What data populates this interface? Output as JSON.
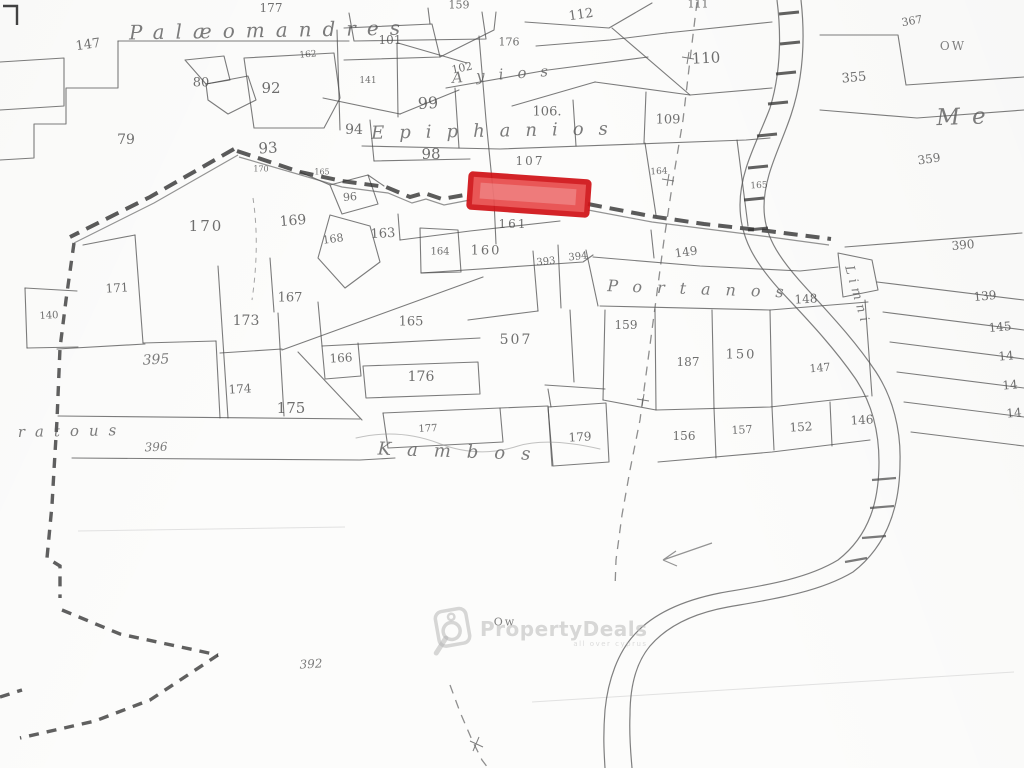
{
  "watermark": {
    "brand": "PropertyDeals",
    "tagline": "all over cyprus",
    "color": "#bdbdbd"
  },
  "map": {
    "highlight": {
      "stroke": "#d01318",
      "fill": "#e84b4b"
    },
    "labels": [
      {
        "text": "147",
        "x": 88,
        "y": 45,
        "s": 13,
        "rot": -8
      },
      {
        "text": "177",
        "x": 271,
        "y": 8,
        "s": 12
      },
      {
        "text": "159",
        "x": 459,
        "y": 5,
        "s": 11
      },
      {
        "text": "112",
        "x": 581,
        "y": 15,
        "s": 13,
        "rot": -8
      },
      {
        "text": "111",
        "x": 698,
        "y": 4,
        "s": 11
      },
      {
        "text": "367",
        "x": 912,
        "y": 21,
        "s": 11,
        "rot": -10
      },
      {
        "text": "OW",
        "x": 953,
        "y": 46,
        "s": 12,
        "cls": "mark",
        "name": "well-mark-ow"
      },
      {
        "text": "101",
        "x": 390,
        "y": 40,
        "s": 12
      },
      {
        "text": "162",
        "x": 308,
        "y": 55,
        "s": 9,
        "rot": -5
      },
      {
        "text": "102",
        "x": 462,
        "y": 68,
        "s": 11,
        "rot": -12
      },
      {
        "text": "176",
        "x": 509,
        "y": 42,
        "s": 11
      },
      {
        "text": "110",
        "x": 706,
        "y": 58,
        "s": 15,
        "rot": -3
      },
      {
        "text": "355",
        "x": 854,
        "y": 78,
        "s": 13,
        "rot": -5
      },
      {
        "text": "80",
        "x": 201,
        "y": 83,
        "s": 13
      },
      {
        "text": "92",
        "x": 271,
        "y": 88,
        "s": 15
      },
      {
        "text": "141",
        "x": 368,
        "y": 81,
        "s": 9
      },
      {
        "text": "99",
        "x": 428,
        "y": 103,
        "s": 16,
        "rot": -3
      },
      {
        "text": "106.",
        "x": 547,
        "y": 112,
        "s": 13
      },
      {
        "text": "109",
        "x": 668,
        "y": 120,
        "s": 13
      },
      {
        "text": "79",
        "x": 126,
        "y": 140,
        "s": 14
      },
      {
        "text": "93",
        "x": 268,
        "y": 148,
        "s": 15,
        "rot": -3
      },
      {
        "text": "94",
        "x": 354,
        "y": 130,
        "s": 14
      },
      {
        "text": "98",
        "x": 431,
        "y": 154,
        "s": 15
      },
      {
        "text": "107",
        "x": 530,
        "y": 161,
        "s": 12,
        "ls": 2
      },
      {
        "text": "359",
        "x": 929,
        "y": 159,
        "s": 12,
        "rot": -8
      },
      {
        "text": "164",
        "x": 659,
        "y": 172,
        "s": 9,
        "rot": -3
      },
      {
        "text": "165",
        "x": 759,
        "y": 186,
        "s": 9,
        "rot": -3
      },
      {
        "text": "170",
        "x": 261,
        "y": 169,
        "s": 8
      },
      {
        "text": "165",
        "x": 322,
        "y": 172,
        "s": 8
      },
      {
        "text": "96",
        "x": 350,
        "y": 197,
        "s": 11,
        "rot": -5
      },
      {
        "text": "170",
        "x": 206,
        "y": 226,
        "s": 15,
        "ls": 2
      },
      {
        "text": "169",
        "x": 293,
        "y": 221,
        "s": 14,
        "rot": -5
      },
      {
        "text": "168",
        "x": 333,
        "y": 239,
        "s": 11,
        "rot": -8
      },
      {
        "text": "163",
        "x": 383,
        "y": 234,
        "s": 13,
        "rot": -3
      },
      {
        "text": "161",
        "x": 513,
        "y": 224,
        "s": 12,
        "ls": 2
      },
      {
        "text": "164",
        "x": 440,
        "y": 252,
        "s": 10
      },
      {
        "text": "160",
        "x": 486,
        "y": 251,
        "s": 13,
        "ls": 2
      },
      {
        "text": "393",
        "x": 546,
        "y": 262,
        "s": 10,
        "rot": -6
      },
      {
        "text": "394",
        "x": 578,
        "y": 257,
        "s": 10,
        "rot": -6
      },
      {
        "text": "149",
        "x": 686,
        "y": 252,
        "s": 12,
        "rot": -8
      },
      {
        "text": "390",
        "x": 963,
        "y": 245,
        "s": 12,
        "rot": -5
      },
      {
        "text": "148",
        "x": 806,
        "y": 299,
        "s": 12,
        "rot": -3
      },
      {
        "text": "139",
        "x": 985,
        "y": 296,
        "s": 12,
        "rot": -5
      },
      {
        "text": "145",
        "x": 1000,
        "y": 327,
        "s": 12,
        "rot": -5
      },
      {
        "text": "14",
        "x": 1006,
        "y": 356,
        "s": 12,
        "rot": -5
      },
      {
        "text": "14",
        "x": 1010,
        "y": 385,
        "s": 12,
        "rot": -5
      },
      {
        "text": "14",
        "x": 1014,
        "y": 413,
        "s": 12,
        "rot": -5
      },
      {
        "text": "171",
        "x": 117,
        "y": 288,
        "s": 12,
        "rot": -3
      },
      {
        "text": "140",
        "x": 49,
        "y": 316,
        "s": 10,
        "rot": -3
      },
      {
        "text": "167",
        "x": 290,
        "y": 298,
        "s": 13
      },
      {
        "text": "173",
        "x": 246,
        "y": 321,
        "s": 14
      },
      {
        "text": "165",
        "x": 411,
        "y": 322,
        "s": 13
      },
      {
        "text": "159",
        "x": 626,
        "y": 325,
        "s": 12
      },
      {
        "text": "395",
        "x": 156,
        "y": 360,
        "s": 14,
        "cls": "script",
        "rot": -3
      },
      {
        "text": "507",
        "x": 516,
        "y": 340,
        "s": 14,
        "ls": 2
      },
      {
        "text": "187",
        "x": 688,
        "y": 362,
        "s": 12
      },
      {
        "text": "150",
        "x": 741,
        "y": 355,
        "s": 13,
        "ls": 2
      },
      {
        "text": "147",
        "x": 820,
        "y": 368,
        "s": 11,
        "rot": -5
      },
      {
        "text": "166",
        "x": 341,
        "y": 358,
        "s": 12,
        "rot": -3
      },
      {
        "text": "176",
        "x": 421,
        "y": 377,
        "s": 14
      },
      {
        "text": "174",
        "x": 240,
        "y": 389,
        "s": 12,
        "rot": -3
      },
      {
        "text": "175",
        "x": 291,
        "y": 408,
        "s": 15
      },
      {
        "text": "177",
        "x": 428,
        "y": 429,
        "s": 10,
        "rot": -3
      },
      {
        "text": "179",
        "x": 580,
        "y": 437,
        "s": 12,
        "rot": -3
      },
      {
        "text": "156",
        "x": 684,
        "y": 436,
        "s": 12
      },
      {
        "text": "157",
        "x": 742,
        "y": 430,
        "s": 11,
        "rot": -3
      },
      {
        "text": "152",
        "x": 801,
        "y": 427,
        "s": 12,
        "rot": -3
      },
      {
        "text": "146",
        "x": 862,
        "y": 420,
        "s": 12,
        "rot": -3
      },
      {
        "text": "396",
        "x": 156,
        "y": 447,
        "s": 12,
        "cls": "script",
        "rot": -2
      },
      {
        "text": "392",
        "x": 311,
        "y": 664,
        "s": 12,
        "cls": "script",
        "rot": -3
      },
      {
        "text": "Ow",
        "x": 505,
        "y": 622,
        "s": 11,
        "cls": "mark",
        "name": "well-mark-ow-2"
      },
      {
        "text": "Palæomandres",
        "x": 270,
        "y": 30,
        "s": 20,
        "ls": 11,
        "rot": -1,
        "cls": "script",
        "name": "place-name-palaeomandres"
      },
      {
        "text": "Ayios",
        "x": 507,
        "y": 74,
        "s": 15,
        "ls": 14,
        "rot": -4,
        "cls": "script",
        "name": "place-name-ayios"
      },
      {
        "text": "Epiphanios",
        "x": 497,
        "y": 131,
        "s": 18,
        "ls": 15,
        "rot": -1,
        "cls": "script",
        "name": "place-name-epiphanios"
      },
      {
        "text": "Me",
        "x": 967,
        "y": 117,
        "s": 23,
        "ls": 12,
        "rot": -2,
        "cls": "script",
        "name": "place-name-me"
      },
      {
        "text": "Portanos",
        "x": 703,
        "y": 289,
        "s": 16,
        "ls": 15,
        "rot": 2,
        "cls": "script",
        "name": "place-name-portanos"
      },
      {
        "text": "Kambos",
        "x": 462,
        "y": 452,
        "s": 18,
        "ls": 16,
        "rot": 2,
        "cls": "script",
        "name": "place-name-kambos"
      },
      {
        "text": "ratous",
        "x": 72,
        "y": 431,
        "s": 15,
        "ls": 10,
        "rot": -1,
        "cls": "script",
        "name": "place-name-ratous"
      },
      {
        "text": "Limni",
        "x": 857,
        "y": 296,
        "s": 13,
        "ls": 5,
        "rot": 74,
        "cls": "script",
        "name": "river-name-limni"
      }
    ]
  }
}
